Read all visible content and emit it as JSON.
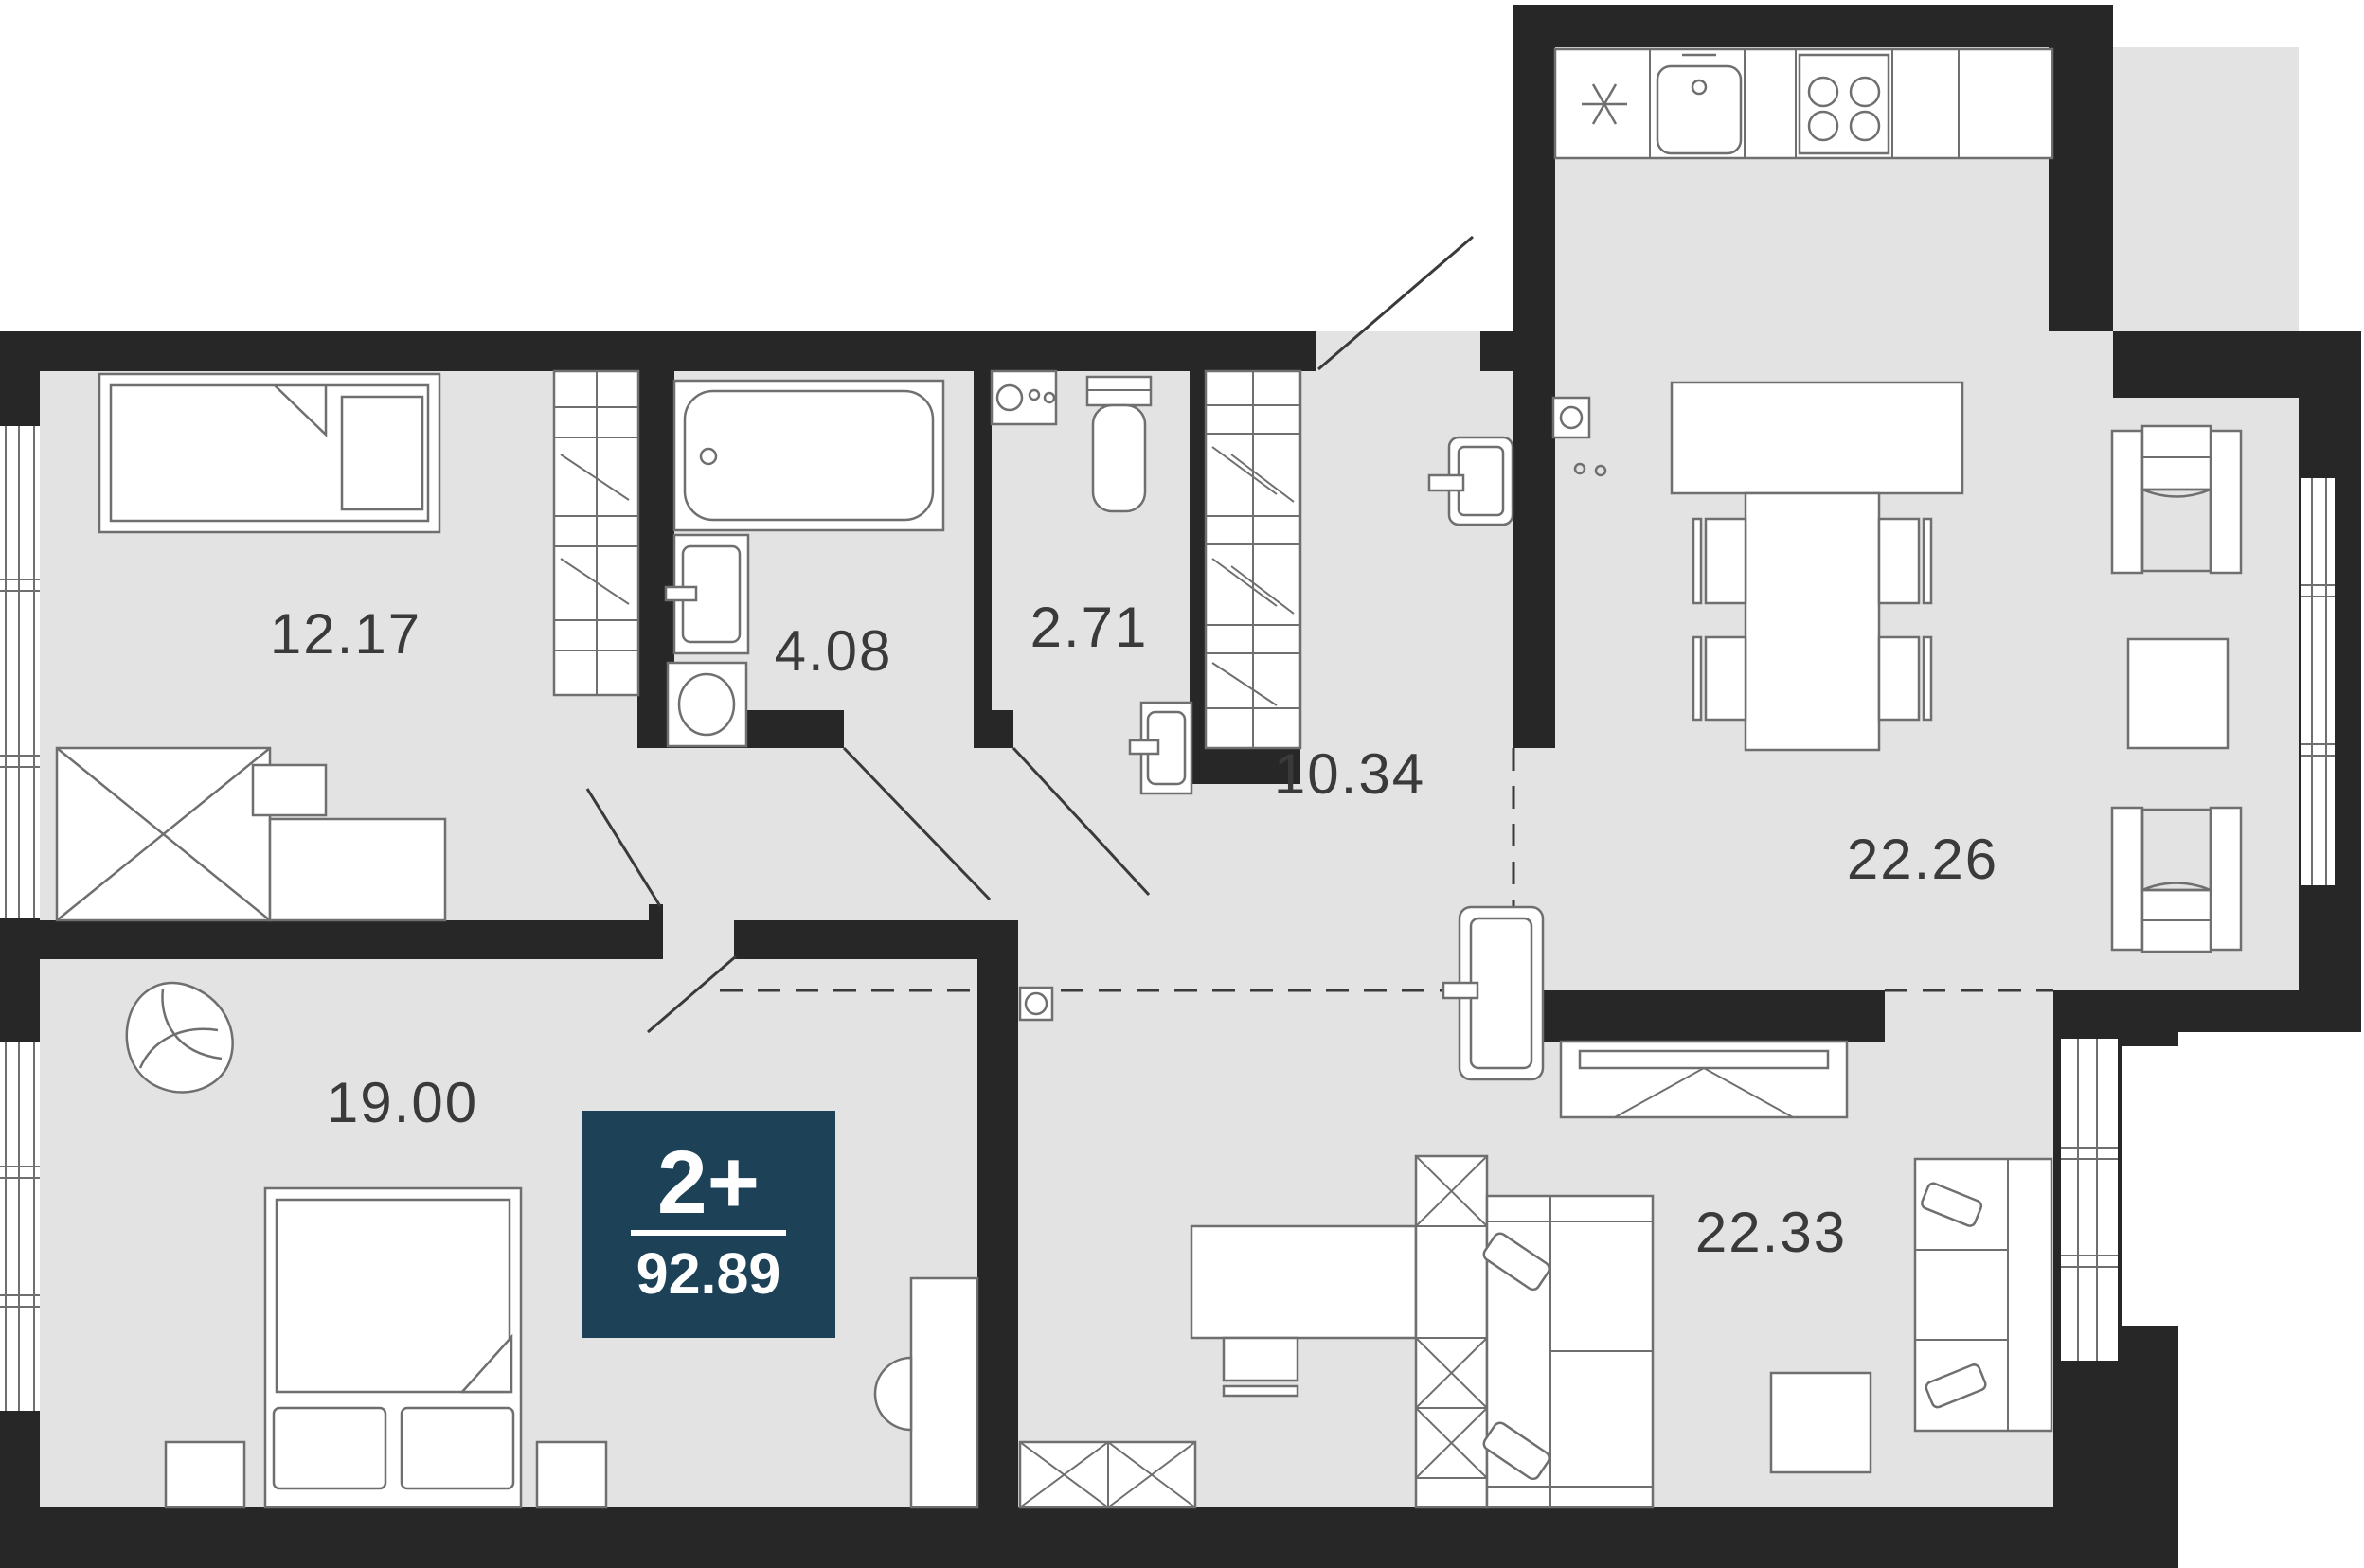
{
  "title": "Apartment floor plan",
  "badge": {
    "rooms_label": "2+",
    "area_total": "92.89"
  },
  "rooms": [
    {
      "name": "bedroom-top",
      "area": "12.17"
    },
    {
      "name": "bathroom",
      "area": "4.08"
    },
    {
      "name": "toilet",
      "area": "2.71"
    },
    {
      "name": "hallway",
      "area": "10.34"
    },
    {
      "name": "kitchen-living",
      "area": "22.26"
    },
    {
      "name": "bedroom-main",
      "area": "19.00"
    },
    {
      "name": "living-room",
      "area": "22.33"
    }
  ],
  "colors": {
    "wall": "#272727",
    "floor": "#e3e3e3",
    "furniture_outline": "#6f6f6f",
    "badge_bg": "#1d4157",
    "badge_text": "#ffffff",
    "label_text": "#3a3a3a"
  },
  "furniture": [
    "single-bed",
    "desk-cabinet",
    "desk",
    "desk-chair",
    "wardrobe",
    "bathtub",
    "bath-sink",
    "washing-machine",
    "dryer",
    "toilet",
    "wc-sink",
    "hall-wardrobe",
    "door-leaf",
    "kitchen-counter",
    "kitchen-sink",
    "stove",
    "kitchen-island",
    "dining-table",
    "dining-chair",
    "armchair",
    "side-table",
    "window",
    "tv-console",
    "work-desk",
    "shelving-unit",
    "sofa",
    "coffee-table",
    "double-bed",
    "nightstand",
    "lounge-chair",
    "floor-lamp",
    "vent-box"
  ]
}
